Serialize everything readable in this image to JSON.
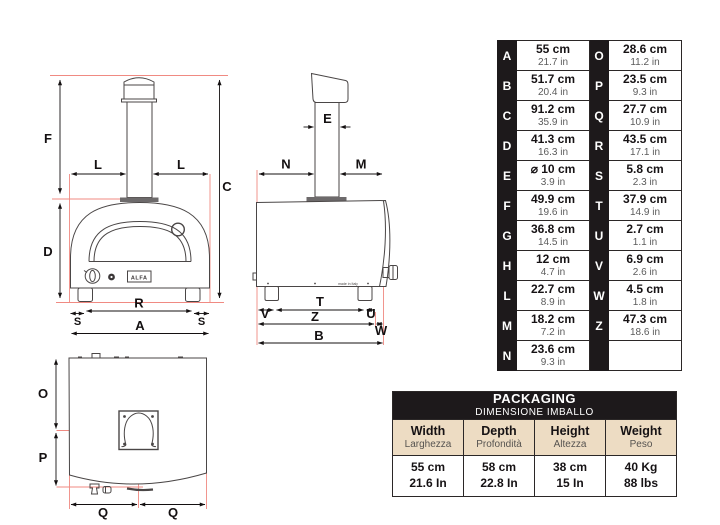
{
  "brand": {
    "logo_text": "ALFA",
    "made_in": "made in Italy"
  },
  "colors": {
    "table_black": "#1d191b",
    "beige": "#eddcc3",
    "guide_red": "#f08a82",
    "drawing_line": "#4a4646",
    "dimension_line": "#141011"
  },
  "dimension_table": {
    "rows": [
      {
        "l": {
          "key": "A",
          "cm": "55 cm",
          "in": "21.7 in"
        },
        "r": {
          "key": "O",
          "cm": "28.6 cm",
          "in": "11.2 in"
        }
      },
      {
        "l": {
          "key": "B",
          "cm": "51.7 cm",
          "in": "20.4 in"
        },
        "r": {
          "key": "P",
          "cm": "23.5 cm",
          "in": "9.3 in"
        }
      },
      {
        "l": {
          "key": "C",
          "cm": "91.2 cm",
          "in": "35.9 in"
        },
        "r": {
          "key": "Q",
          "cm": "27.7 cm",
          "in": "10.9 in"
        }
      },
      {
        "l": {
          "key": "D",
          "cm": "41.3 cm",
          "in": "16.3 in"
        },
        "r": {
          "key": "R",
          "cm": "43.5 cm",
          "in": "17.1 in"
        }
      },
      {
        "l": {
          "key": "E",
          "cm": "⌀ 10 cm",
          "in": "3.9 in"
        },
        "r": {
          "key": "S",
          "cm": "5.8 cm",
          "in": "2.3 in"
        }
      },
      {
        "l": {
          "key": "F",
          "cm": "49.9 cm",
          "in": "19.6 in"
        },
        "r": {
          "key": "T",
          "cm": "37.9 cm",
          "in": "14.9 in"
        }
      },
      {
        "l": {
          "key": "G",
          "cm": "36.8 cm",
          "in": "14.5 in"
        },
        "r": {
          "key": "U",
          "cm": "2.7 cm",
          "in": "1.1 in"
        }
      },
      {
        "l": {
          "key": "H",
          "cm": "12 cm",
          "in": "4.7 in"
        },
        "r": {
          "key": "V",
          "cm": "6.9 cm",
          "in": "2.6 in"
        }
      },
      {
        "l": {
          "key": "L",
          "cm": "22.7 cm",
          "in": "8.9 in"
        },
        "r": {
          "key": "W",
          "cm": "4.5 cm",
          "in": "1.8 in"
        }
      },
      {
        "l": {
          "key": "M",
          "cm": "18.2 cm",
          "in": "7.2 in"
        },
        "r": {
          "key": "Z",
          "cm": "47.3 cm",
          "in": "18.6 in"
        }
      },
      {
        "l": {
          "key": "N",
          "cm": "23.6 cm",
          "in": "9.3 in"
        },
        "r": {
          "key": "",
          "cm": "",
          "in": ""
        }
      }
    ]
  },
  "packaging": {
    "title": "PACKAGING",
    "subtitle": "DIMENSIONE IMBALLO",
    "columns": [
      {
        "label_en": "Width",
        "label_it": "Larghezza",
        "metric": "55 cm",
        "imperial": "21.6 In"
      },
      {
        "label_en": "Depth",
        "label_it": "Profondità",
        "metric": "58 cm",
        "imperial": "22.8 In"
      },
      {
        "label_en": "Height",
        "label_it": "Altezza",
        "metric": "38 cm",
        "imperial": "15 In"
      },
      {
        "label_en": "Weight",
        "label_it": "Peso",
        "metric": "40 Kg",
        "imperial": "88 lbs"
      }
    ]
  },
  "views": {
    "front": {
      "labels": {
        "F": "F",
        "C": "C",
        "D": "D",
        "L": "L",
        "R": "R",
        "S": "S",
        "A": "A"
      }
    },
    "side": {
      "labels": {
        "E": "E",
        "N": "N",
        "M": "M",
        "T": "T",
        "V": "V",
        "U": "U",
        "Z": "Z",
        "W": "W",
        "B": "B"
      }
    },
    "bottom": {
      "labels": {
        "O": "O",
        "P": "P",
        "Q": "Q"
      }
    }
  }
}
